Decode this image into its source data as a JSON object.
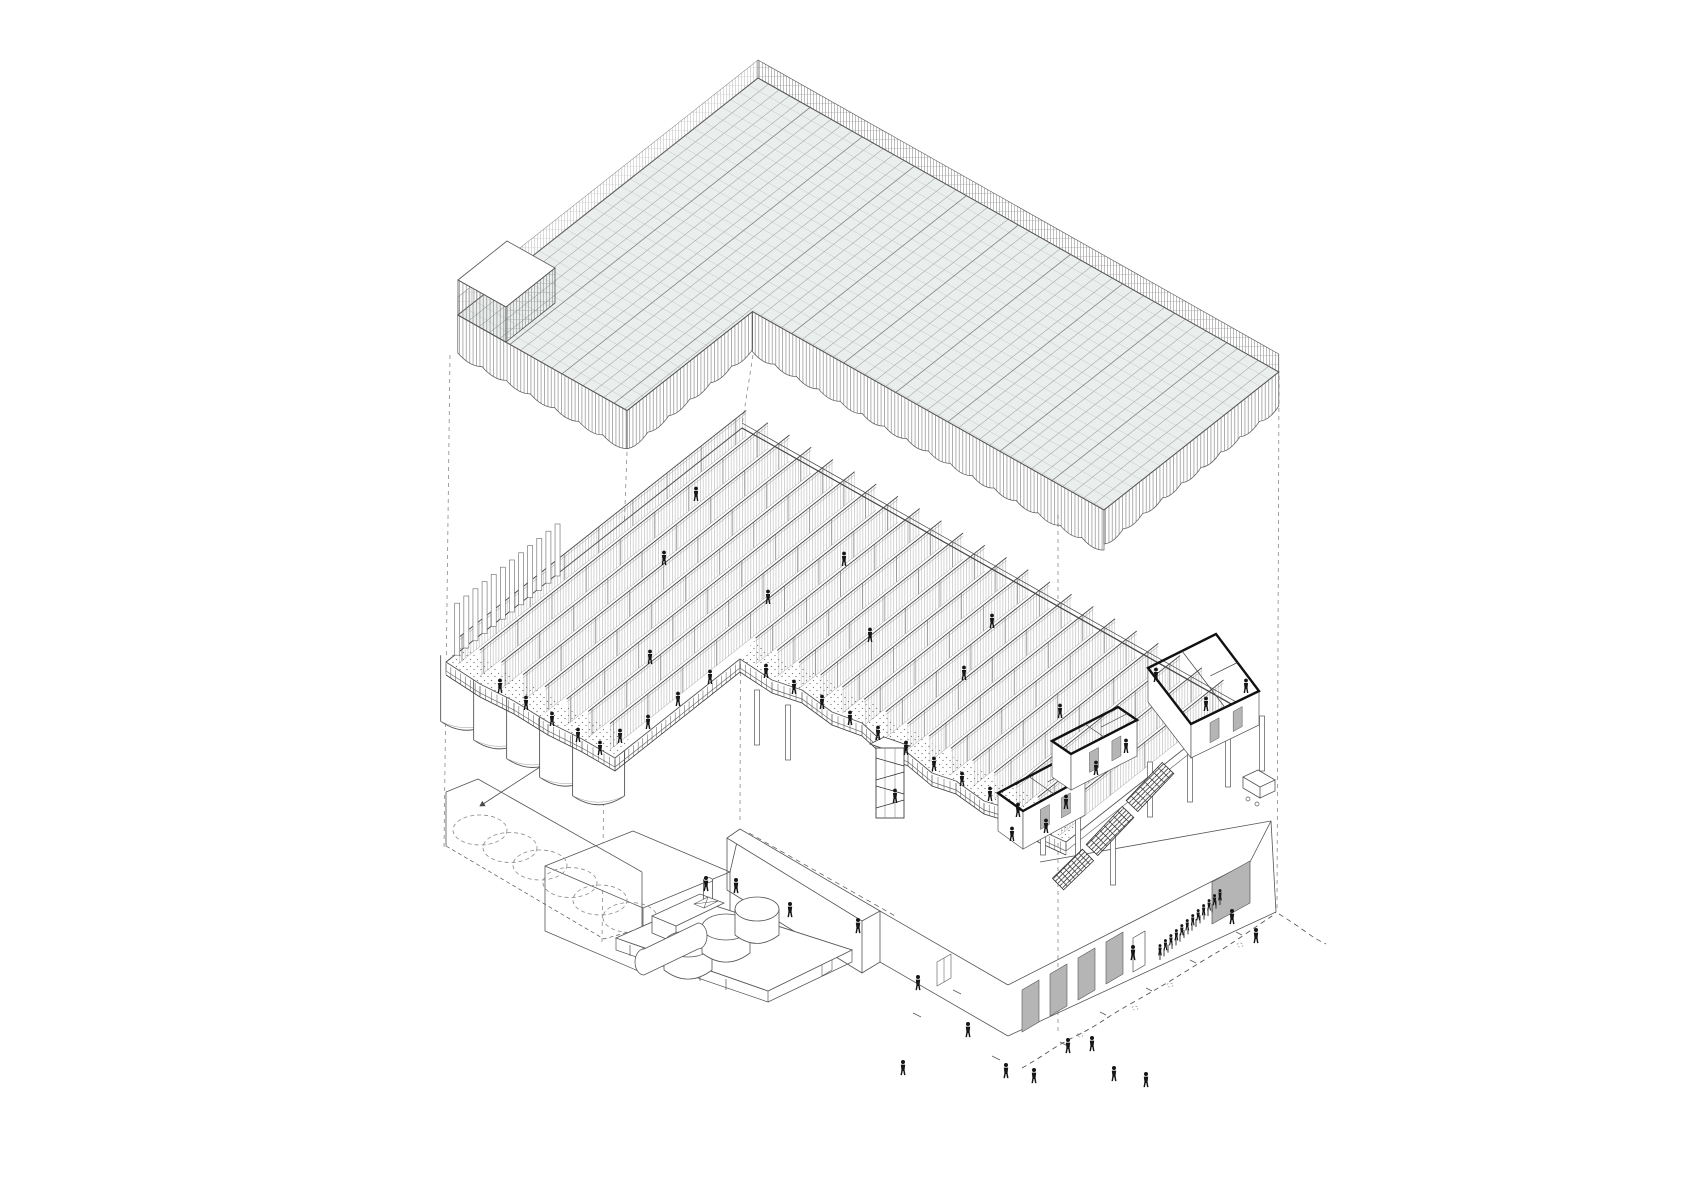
{
  "meta": {
    "kind": "architectural-exploded-axonometric-drawing",
    "visible_text": "none"
  },
  "palette": {
    "background": "#ffffff",
    "line_dark": "#3f3f3f",
    "line": "#555555",
    "line_light": "#999999",
    "cell_fill": "#e9ece9",
    "door_gray": "#b5b5b5",
    "figure_black": "#161616"
  },
  "iso": {
    "u": [
      0.868,
      0.49
    ],
    "v": [
      -0.76,
      0.6
    ]
  },
  "roof": {
    "origin": [
      758,
      78
    ],
    "s_max": 600,
    "t_max": 395,
    "arm_s": 195,
    "right_t": 230,
    "parapet_h": 18,
    "fascia_right": 40,
    "fascia_left": 38,
    "fascia_cap": 34,
    "scallop_step": 26,
    "vault_line_step": 60,
    "tower_top": [
      [
        507,
        241
      ],
      [
        555,
        268
      ],
      [
        506,
        307
      ],
      [
        458,
        280
      ]
    ],
    "tower_west": [
      [
        458,
        280
      ],
      [
        506,
        307
      ],
      [
        506,
        342
      ],
      [
        458,
        315
      ]
    ],
    "tower_south": [
      [
        506,
        307
      ],
      [
        555,
        268
      ],
      [
        555,
        303
      ],
      [
        506,
        342
      ]
    ]
  },
  "floor": {
    "origin": [
      742,
      428
    ],
    "s_max": 570,
    "arm_s": 195,
    "right_t": 222,
    "arm_t": 385,
    "fin_start": 10,
    "fin_step": 25,
    "fin_h": 26,
    "outline": {
      "left": [
        [
          446,
          662
        ],
        [
          480,
          684
        ],
        [
          514,
          701
        ],
        [
          548,
          722
        ],
        [
          582,
          739
        ],
        [
          615,
          758
        ]
      ],
      "notch": [
        [
          615,
          758
        ],
        [
          740,
          659
        ]
      ],
      "right": [
        [
          740,
          659
        ],
        [
          772,
          680
        ],
        [
          802,
          690
        ],
        [
          832,
          712
        ],
        [
          862,
          723
        ],
        [
          884,
          743
        ],
        [
          908,
          753
        ],
        [
          932,
          773
        ],
        [
          956,
          781
        ],
        [
          984,
          801
        ],
        [
          1010,
          809
        ],
        [
          1038,
          829
        ],
        [
          1066,
          842
        ]
      ],
      "cap": [
        [
          1237,
          707
        ],
        [
          1066,
          842
        ]
      ]
    },
    "apex": [
      742,
      428
    ],
    "west_corner": [
      446,
      662
    ],
    "east_corner": [
      1237,
      707
    ],
    "silos": {
      "count": 5,
      "start_s": 5,
      "step_s": 38,
      "t": 368,
      "r": 26,
      "h": 66
    },
    "slats": {
      "s": 2,
      "t0": 245,
      "t1": 385,
      "step": 12,
      "w": 5,
      "h": 52
    },
    "stair_tower": {
      "x": 876,
      "y": 748,
      "w": 28,
      "h": 70
    },
    "rooms": [
      {
        "top": [
          [
            998,
            793
          ],
          [
            1060,
            760
          ],
          [
            1085,
            777
          ],
          [
            1023,
            811
          ]
        ],
        "drop": 38
      },
      {
        "top": [
          [
            1052,
            741
          ],
          [
            1118,
            707
          ],
          [
            1137,
            720
          ],
          [
            1071,
            754
          ]
        ],
        "drop": 36
      },
      {
        "top": [
          [
            1148,
            668
          ],
          [
            1216,
            634
          ],
          [
            1259,
            691
          ],
          [
            1191,
            724
          ]
        ],
        "drop": 34
      }
    ],
    "room_columns": [
      [
        1043,
        800
      ],
      [
        1078,
        815
      ],
      [
        1113,
        830
      ],
      [
        1150,
        762
      ],
      [
        1190,
        747
      ],
      [
        1228,
        732
      ],
      [
        1262,
        716
      ],
      [
        757,
        690
      ],
      [
        788,
        705
      ]
    ],
    "escalator": [
      [
        [
          1168,
          768
        ],
        [
          1132,
          806
        ]
      ],
      [
        [
          1128,
          812
        ],
        [
          1092,
          850
        ]
      ],
      [
        [
          1088,
          855
        ],
        [
          1058,
          884
        ]
      ]
    ],
    "truck": [
      1243,
      770
    ]
  },
  "people": {
    "upper": [
      [
        500,
        690
      ],
      [
        526,
        707
      ],
      [
        552,
        723
      ],
      [
        578,
        739
      ],
      [
        600,
        752
      ],
      [
        620,
        740
      ],
      [
        648,
        726
      ],
      [
        678,
        703
      ],
      [
        710,
        681
      ],
      [
        650,
        661
      ],
      [
        766,
        675
      ],
      [
        794,
        691
      ],
      [
        822,
        706
      ],
      [
        850,
        722
      ],
      [
        878,
        737
      ],
      [
        906,
        752
      ],
      [
        934,
        768
      ],
      [
        962,
        783
      ],
      [
        990,
        798
      ],
      [
        1018,
        814
      ],
      [
        1046,
        830
      ],
      [
        895,
        800
      ],
      [
        1012,
        838
      ],
      [
        1066,
        806
      ],
      [
        1096,
        772
      ],
      [
        1126,
        750
      ],
      [
        1206,
        708
      ],
      [
        1246,
        690
      ],
      [
        664,
        562
      ],
      [
        768,
        601
      ],
      [
        870,
        639
      ],
      [
        964,
        677
      ],
      [
        1060,
        715
      ],
      [
        1156,
        679
      ],
      [
        696,
        498
      ],
      [
        844,
        563
      ],
      [
        992,
        625
      ]
    ],
    "ground": [
      [
        706,
        888
      ],
      [
        736,
        890
      ],
      [
        790,
        914
      ],
      [
        858,
        930
      ],
      [
        918,
        987
      ],
      [
        968,
        1034
      ],
      [
        1006,
        1075
      ],
      [
        1034,
        1080
      ],
      [
        1068,
        1050
      ],
      [
        1092,
        1048
      ],
      [
        1114,
        1078
      ],
      [
        1146,
        1084
      ],
      [
        1133,
        957
      ],
      [
        1232,
        921
      ],
      [
        1256,
        940
      ],
      [
        903,
        1072
      ]
    ],
    "crowd": {
      "from": [
        1160,
        958
      ],
      "to": [
        1220,
        903
      ],
      "count": 12,
      "ticks": 16
    }
  },
  "projection_lines": [
    [
      450,
      355,
      444,
      848
    ],
    [
      627,
      452,
      616,
      750
    ],
    [
      604,
      762,
      602,
      942
    ],
    [
      753,
      355,
      742,
      425
    ],
    [
      741,
      432,
      740,
      822
    ],
    [
      1058,
      515,
      1058,
      1032
    ],
    [
      1279,
      376,
      1277,
      908
    ]
  ],
  "ground_circles": {
    "start": [
      480,
      830
    ],
    "step": [
      30,
      17.5
    ],
    "count": 6,
    "rx": 27,
    "ry": 15
  },
  "ground_marks": [
    [
      1080,
      1035
    ],
    [
      1170,
      985
    ],
    [
      1240,
      945
    ],
    [
      1135,
      1008
    ]
  ],
  "leader_arrow": [
    560,
    754,
    480,
    806
  ],
  "tank_yard": {
    "platform": [
      [
        616,
        938
      ],
      [
        700,
        901
      ],
      [
        852,
        950
      ],
      [
        768,
        991
      ]
    ],
    "tanks": [
      [
        688,
        944,
        24,
        13
      ],
      [
        726,
        927,
        24,
        13
      ],
      [
        757,
        909,
        22,
        12
      ]
    ],
    "htank": {
      "x1": 644,
      "y1": 962,
      "x2": 698,
      "y2": 936,
      "rx": 9,
      "ry": 13
    },
    "box": [
      [
        652,
        916
      ],
      [
        700,
        894
      ],
      [
        724,
        903
      ],
      [
        676,
        926
      ]
    ],
    "box_h": 17,
    "chimney": [
      708,
      880,
      9,
      22
    ],
    "smallbox": [
      [
        694,
        904
      ],
      [
        708,
        897
      ],
      [
        718,
        901
      ],
      [
        704,
        908
      ]
    ]
  },
  "base_paths": [
    {
      "d": "M545,866 L633,831 L730,872 L643,908 Z",
      "f": "#ffffff"
    },
    {
      "d": "M545,866 L545,931 L643,973 L643,908"
    },
    {
      "d": "M643,973 L730,938 L730,872"
    },
    {
      "d": "M730,872 L740,829"
    },
    {
      "d": "M740,829 L880,911 L862,921 L727,838 Z",
      "f": "#ffffff"
    },
    {
      "d": "M727,838 L727,890 L862,973 L862,921"
    },
    {
      "d": "M880,911 L880,962 L862,973"
    },
    {
      "d": "M880,962 L1008,1036"
    },
    {
      "d": "M880,911 L1008,985"
    },
    {
      "d": "M1008,985 L1250,862"
    },
    {
      "d": "M1008,1036 L1276,912"
    },
    {
      "d": "M1250,862 L1271,821 L1276,912"
    },
    {
      "d": "M1040,862 L1271,821"
    },
    {
      "d": "M749,833 L897,917",
      "da": "5 4",
      "w": 0.7
    },
    {
      "d": "M1022,990 l17,-10 l0,42 l-17,10 Z",
      "f": "#b5b5b5",
      "w": 0.6
    },
    {
      "d": "M1050,974 l17,-10 l0,42 l-17,10 Z",
      "f": "#b5b5b5",
      "w": 0.6
    },
    {
      "d": "M1078,958 l17,-10 l0,42 l-17,10 Z",
      "f": "#b5b5b5",
      "w": 0.6
    },
    {
      "d": "M1106,942 l17,-10 l0,42 l-17,10 Z",
      "f": "#b5b5b5",
      "w": 0.6
    },
    {
      "d": "M1133,938 l12,-7 l0,34 l-12,7 Z",
      "f": "#ffffff",
      "w": 0.7
    },
    {
      "d": "M1212,882 l38,-21 l0,42 l-38,21 Z",
      "f": "#b5b5b5",
      "w": 0.7
    },
    {
      "d": "M822,952 l10,-6 l0,24 l-10,6 Z",
      "f": "#ffffff",
      "w": 0.6
    },
    {
      "d": "M937,962 l14,-8 l0,24 l-14,8 Z",
      "f": "#ffffff",
      "w": 0.6
    },
    {
      "d": "M944,958 l0,24",
      "w": 0.5
    },
    {
      "d": "M446,792 L478,779 L642,872"
    },
    {
      "d": "M446,792 L446,846"
    },
    {
      "d": "M642,872 L642,928"
    },
    {
      "d": "M446,846 L604,939 L642,928",
      "da": "4 3",
      "w": 0.7
    },
    {
      "d": "M1022,1068 Q1036,1060 1048,1052 T1076,1036 T1104,1020 T1132,1003 T1160,987 T1188,970 T1216,953 T1244,935 T1272,916 L1276,912",
      "da": "5 4",
      "w": 0.9
    },
    {
      "d": "M1279,914 Q1295,924 1306,932 T1326,944",
      "da": "5 4",
      "w": 0.8
    },
    {
      "d": "M1060,1042 l6,3 M1100,1012 l6,3 M1146,988 l6,3 M1190,960 l6,3 M1236,932 l6,3",
      "w": 0.7
    },
    {
      "d": "M913,1013 l8,4 M953,990 l8,4 M992,1056 l8,4",
      "w": 0.7
    }
  ]
}
